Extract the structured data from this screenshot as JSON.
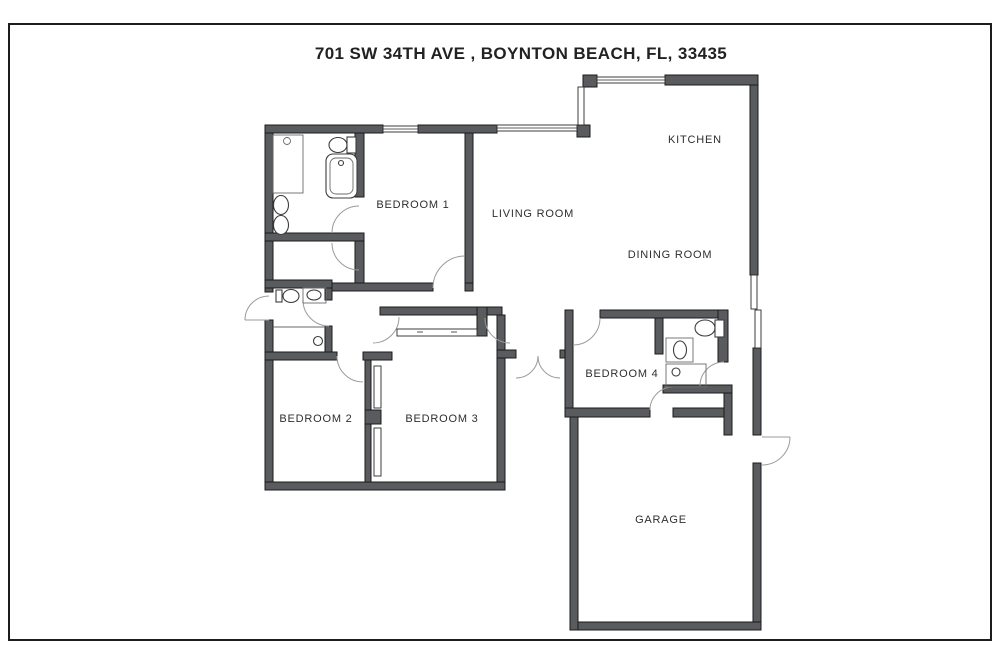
{
  "title": "701 SW 34TH AVE , BOYNTON BEACH, FL, 33435",
  "page": {
    "background": "#ffffff",
    "frame_color": "#1c1c1c",
    "wall_color": "#595b5e",
    "door_arc_color": "#9b9b9b"
  },
  "floor_plan": {
    "rooms": [
      {
        "id": "kitchen",
        "label": "KITCHEN"
      },
      {
        "id": "living-room",
        "label": "LIVING ROOM"
      },
      {
        "id": "dining-room",
        "label": "DINING ROOM"
      },
      {
        "id": "bedroom-1",
        "label": "BEDROOM 1"
      },
      {
        "id": "bedroom-2",
        "label": "BEDROOM 2"
      },
      {
        "id": "bedroom-3",
        "label": "BEDROOM 3"
      },
      {
        "id": "bedroom-4",
        "label": "BEDROOM 4"
      },
      {
        "id": "garage",
        "label": "GARAGE"
      }
    ],
    "fixtures": [
      "bathtub-icon",
      "toilet-icon",
      "double-sink-icon",
      "vanity-sink-icon",
      "shower-drain-icon",
      "closet-sliding-door-icon",
      "window-icon",
      "door-swing-icon"
    ]
  }
}
